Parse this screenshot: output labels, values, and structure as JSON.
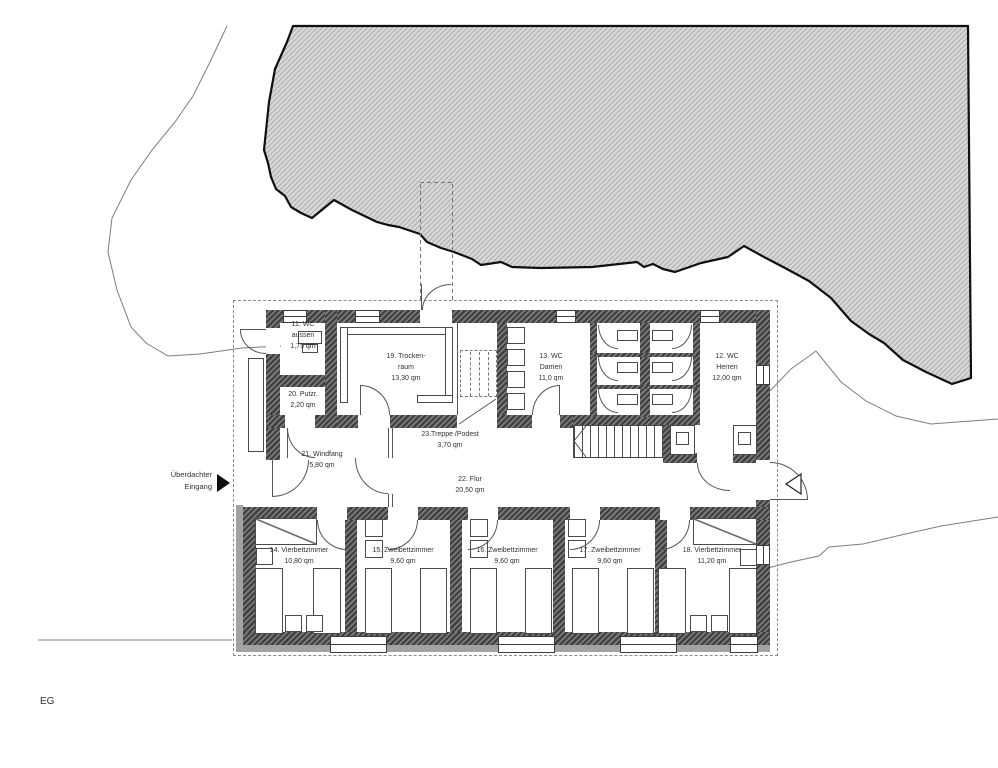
{
  "floor_plan": {
    "floor_label": "EG",
    "entrance": {
      "line1": "Überdachter",
      "line2": "Eingang"
    },
    "rooms": {
      "wc_aussen": {
        "lines": [
          "11. WC",
          "aussen",
          "1,75 qm"
        ]
      },
      "putzraum": {
        "lines": [
          "20. Putzr.",
          "2,20 qm"
        ]
      },
      "trockenraum": {
        "lines": [
          "19. Trocken-",
          "raum",
          "13,30 qm"
        ]
      },
      "treppe_podest": {
        "lines": [
          "23.Treppe /Podest",
          "3,70 qm"
        ]
      },
      "wc_damen": {
        "lines": [
          "13. WC",
          "Damen",
          "11,0 qm"
        ]
      },
      "wc_herren": {
        "lines": [
          "12. WC",
          "Herren",
          "12,00 qm"
        ]
      },
      "windfang": {
        "lines": [
          "21. Windfang",
          "5,80 qm"
        ]
      },
      "flur": {
        "lines": [
          "22. Flur",
          "20,50 qm"
        ]
      },
      "zimmer_14": {
        "lines": [
          "14. Vierbettzimmer",
          "10,80 qm"
        ]
      },
      "zimmer_15": {
        "lines": [
          "15. Zweibettzimmer",
          "9,60 qm"
        ]
      },
      "zimmer_16": {
        "lines": [
          "16. Zweibettzimmer",
          "9,60 qm"
        ]
      },
      "zimmer_17": {
        "lines": [
          "17. Zweibettzimmer",
          "9,60 qm"
        ]
      },
      "zimmer_18": {
        "lines": [
          "18. Vierbettzimmer",
          "11,20 qm"
        ]
      }
    },
    "colors": {
      "wall": "#4a4a4a",
      "terrain_fill": "#d9d9d9",
      "terrain_hatch": "#b2b2b2",
      "terrain_outline": "#101010",
      "text": "#303030"
    }
  }
}
